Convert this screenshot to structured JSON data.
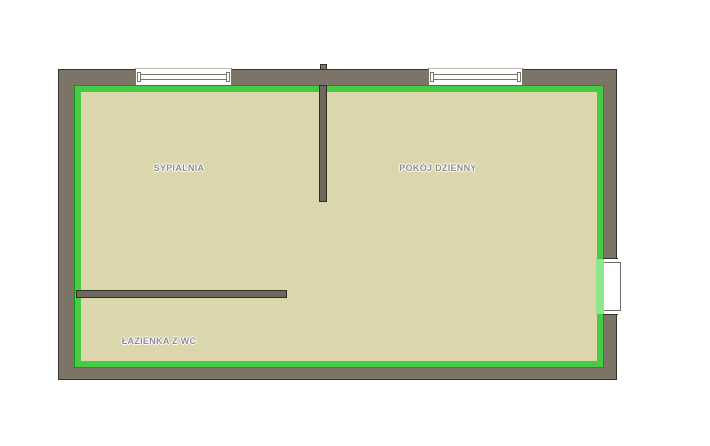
{
  "colors": {
    "background": "#ffffff",
    "wall": "#7b7467",
    "wall-outline": "#34332c",
    "floor": "#dcd6ad",
    "boundary": "#46cb46",
    "boundary-outline": "#1a961a",
    "door-highlight": "#8ce88c",
    "window-frame": "#77776d",
    "jamb": "#6b6b6b",
    "label": "#8c8c8c"
  },
  "rooms": [
    {
      "id": "sypialnia",
      "label": "SYPIALNIA"
    },
    {
      "id": "pokoj-dzienny",
      "label": "POKÓJ DZIENNY"
    },
    {
      "id": "lazienka-z-wc",
      "label": "ŁAZIENKA Z WC"
    }
  ],
  "features": {
    "window_count": 2,
    "door_count": 1,
    "interior_wall_count": 2
  }
}
